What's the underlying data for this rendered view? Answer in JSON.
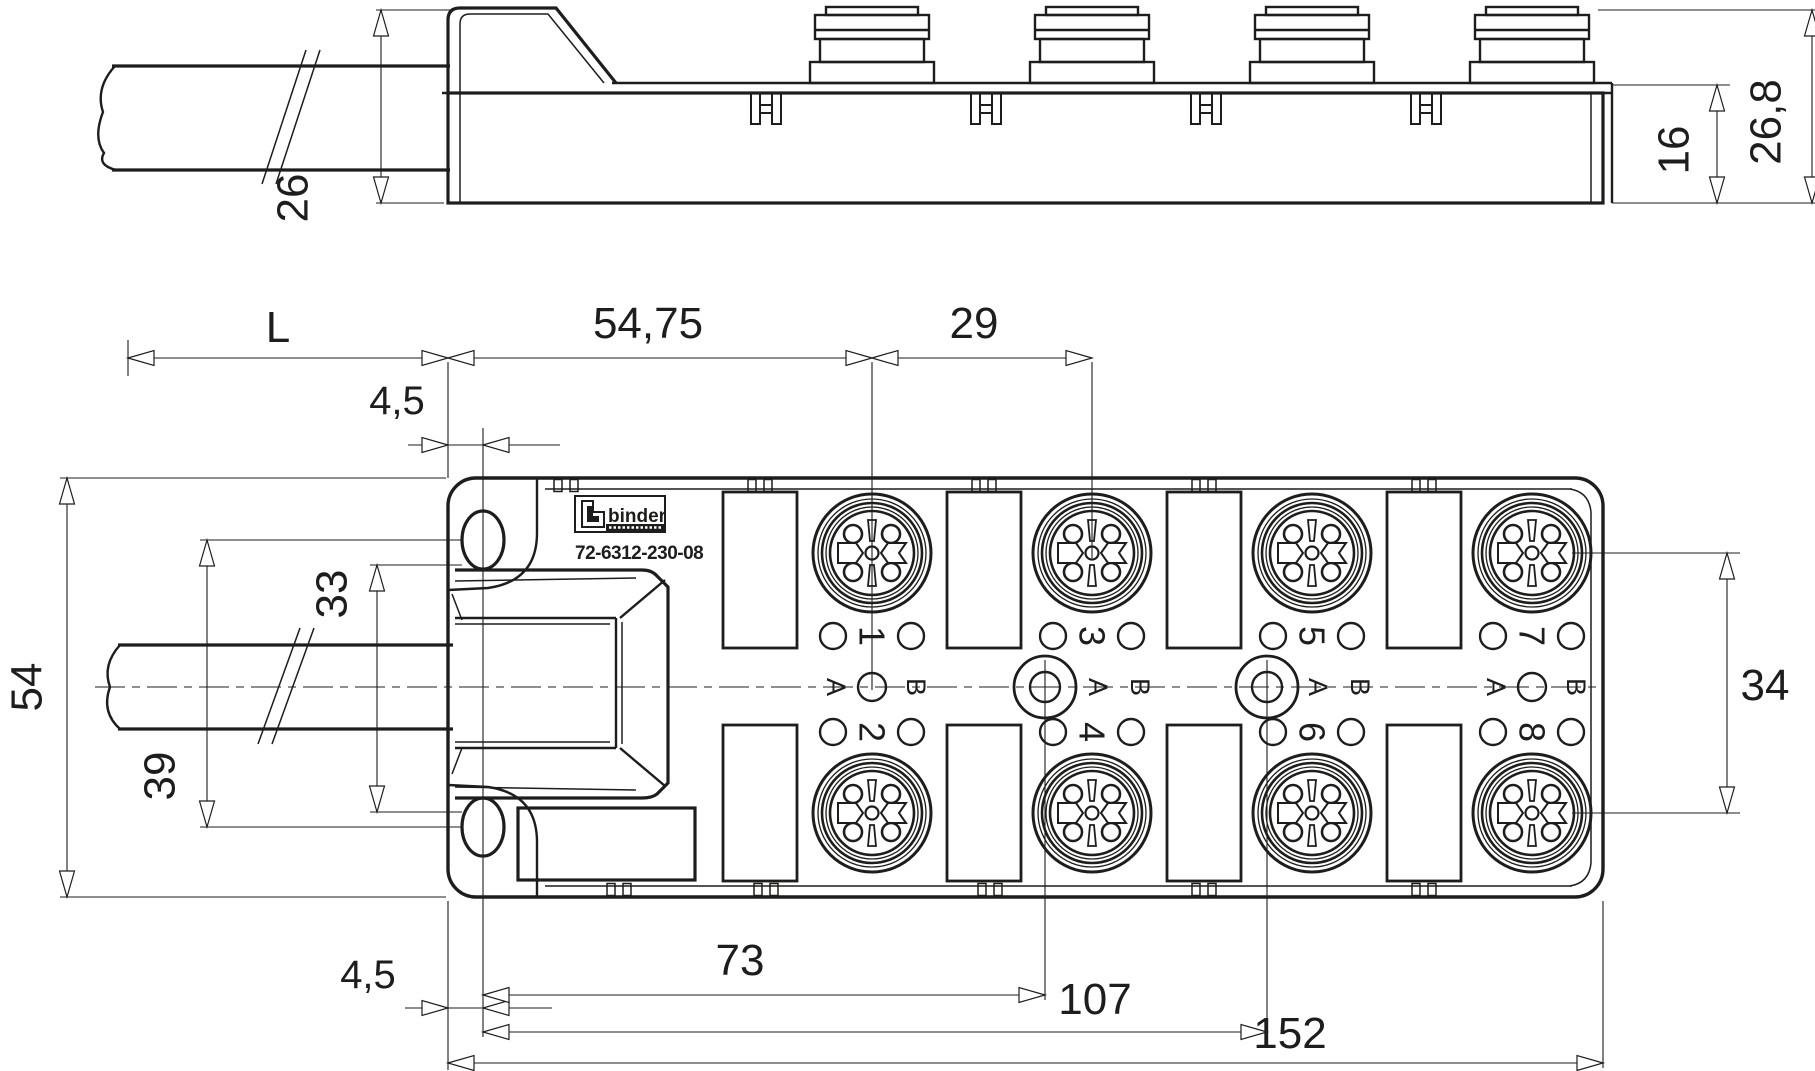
{
  "brand": {
    "logo_text": "binder",
    "part_number": "72-6312-230-08"
  },
  "side_view": {
    "dims": {
      "hood_height": "26",
      "body_height": "16",
      "total_height": "26,8"
    }
  },
  "top_view": {
    "dims": {
      "cable_length": "L",
      "left_to_first_port": "54,75",
      "port_pitch": "29",
      "edge_to_slot_top": "4,5",
      "height": "54",
      "slot_inner_span": "33",
      "slot_center_span": "39",
      "edge_to_slot_bottom": "4,5",
      "slot_to_fixing1": "73",
      "slot_to_fixing2": "107",
      "width": "152",
      "port_row_span": "34"
    },
    "columns": [
      {
        "top_port": "1",
        "bottom_port": "2",
        "left_code": "A",
        "right_code": "B"
      },
      {
        "top_port": "3",
        "bottom_port": "4",
        "left_code": "A",
        "right_code": "B"
      },
      {
        "top_port": "5",
        "bottom_port": "6",
        "left_code": "A",
        "right_code": "B"
      },
      {
        "top_port": "7",
        "bottom_port": "8",
        "left_code": "A",
        "right_code": "B"
      }
    ]
  }
}
